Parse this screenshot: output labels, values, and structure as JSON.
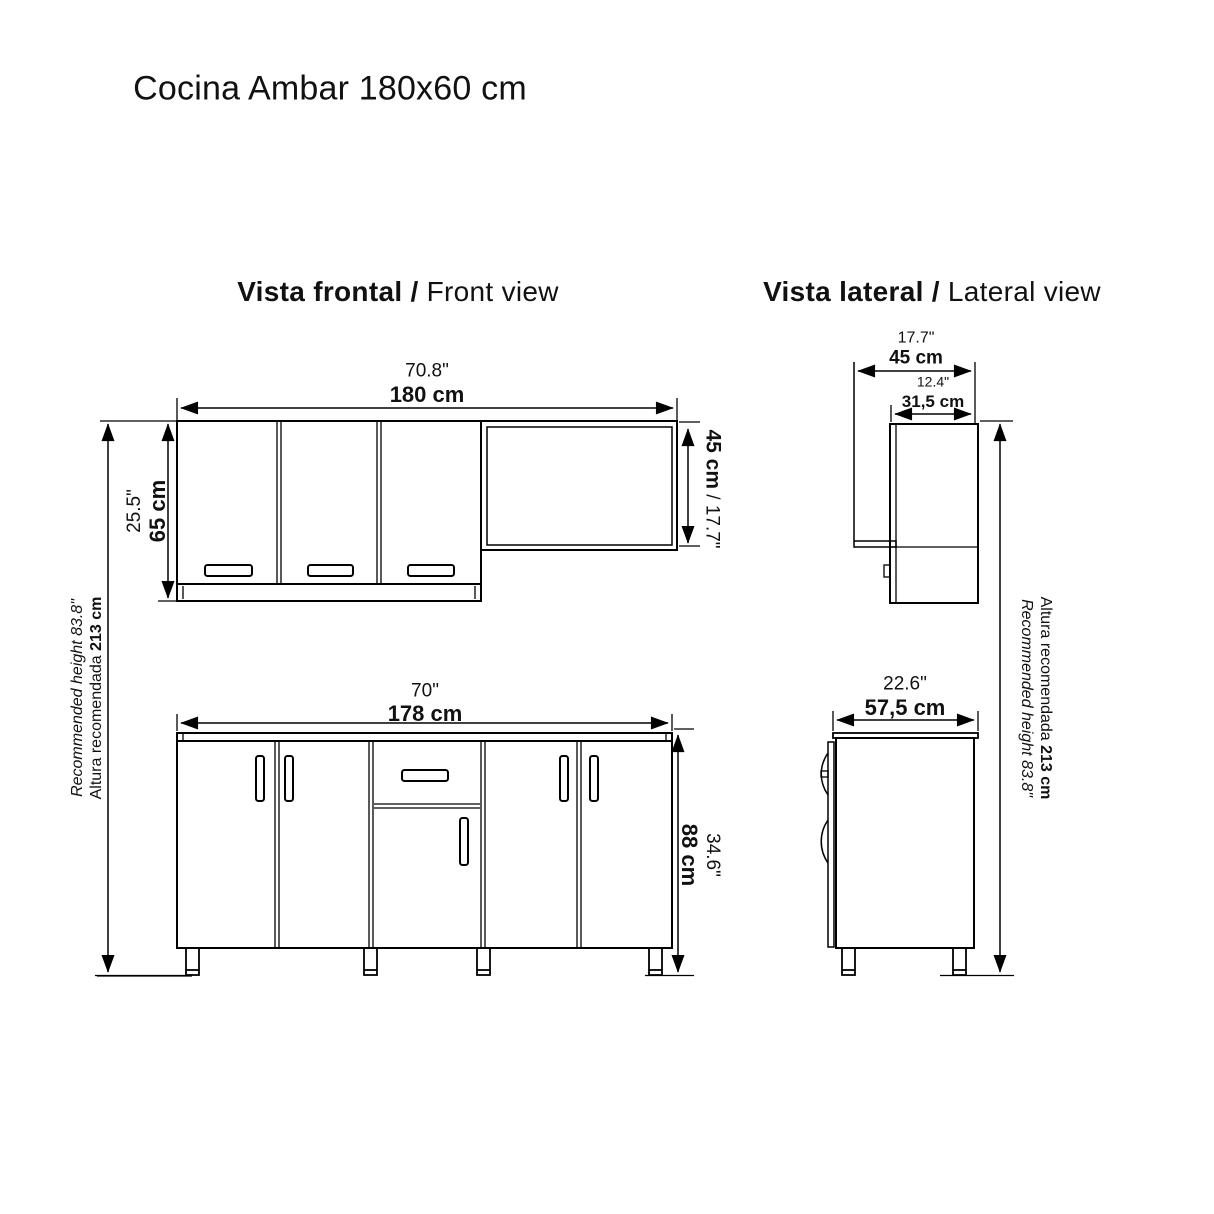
{
  "title": "Cocina Ambar 180x60 cm",
  "colors": {
    "line": "#000000",
    "text": "#111111",
    "background": "#ffffff"
  },
  "front_view": {
    "heading_bold": "Vista frontal / ",
    "heading_regular": "Front view",
    "upper_cabinet": {
      "width_inches": "70.8\"",
      "width_cm": "180 cm",
      "height_inches": "25.5\"",
      "height_cm": "65 cm",
      "open_shelf_height_cm": "45 cm",
      "open_shelf_height_inches": " / 17.7\""
    },
    "lower_cabinet": {
      "width_inches": "70\"",
      "width_cm": "178 cm",
      "height_inches": "34.6\"",
      "height_cm": "88 cm"
    }
  },
  "lateral_view": {
    "heading_bold": "Vista lateral / ",
    "heading_regular": "Lateral view",
    "upper_cabinet": {
      "total_depth_inches": "17.7\"",
      "total_depth_cm": "45 cm",
      "cabinet_depth_inches": "12.4\"",
      "cabinet_depth_cm": "31,5 cm"
    },
    "lower_cabinet": {
      "depth_inches": "22.6\"",
      "depth_cm": "57,5 cm"
    }
  },
  "recommended_height": {
    "english": "Recommended height 83.8\"",
    "spanish_prefix": "Altura recomendada ",
    "spanish_value": "213 cm"
  }
}
